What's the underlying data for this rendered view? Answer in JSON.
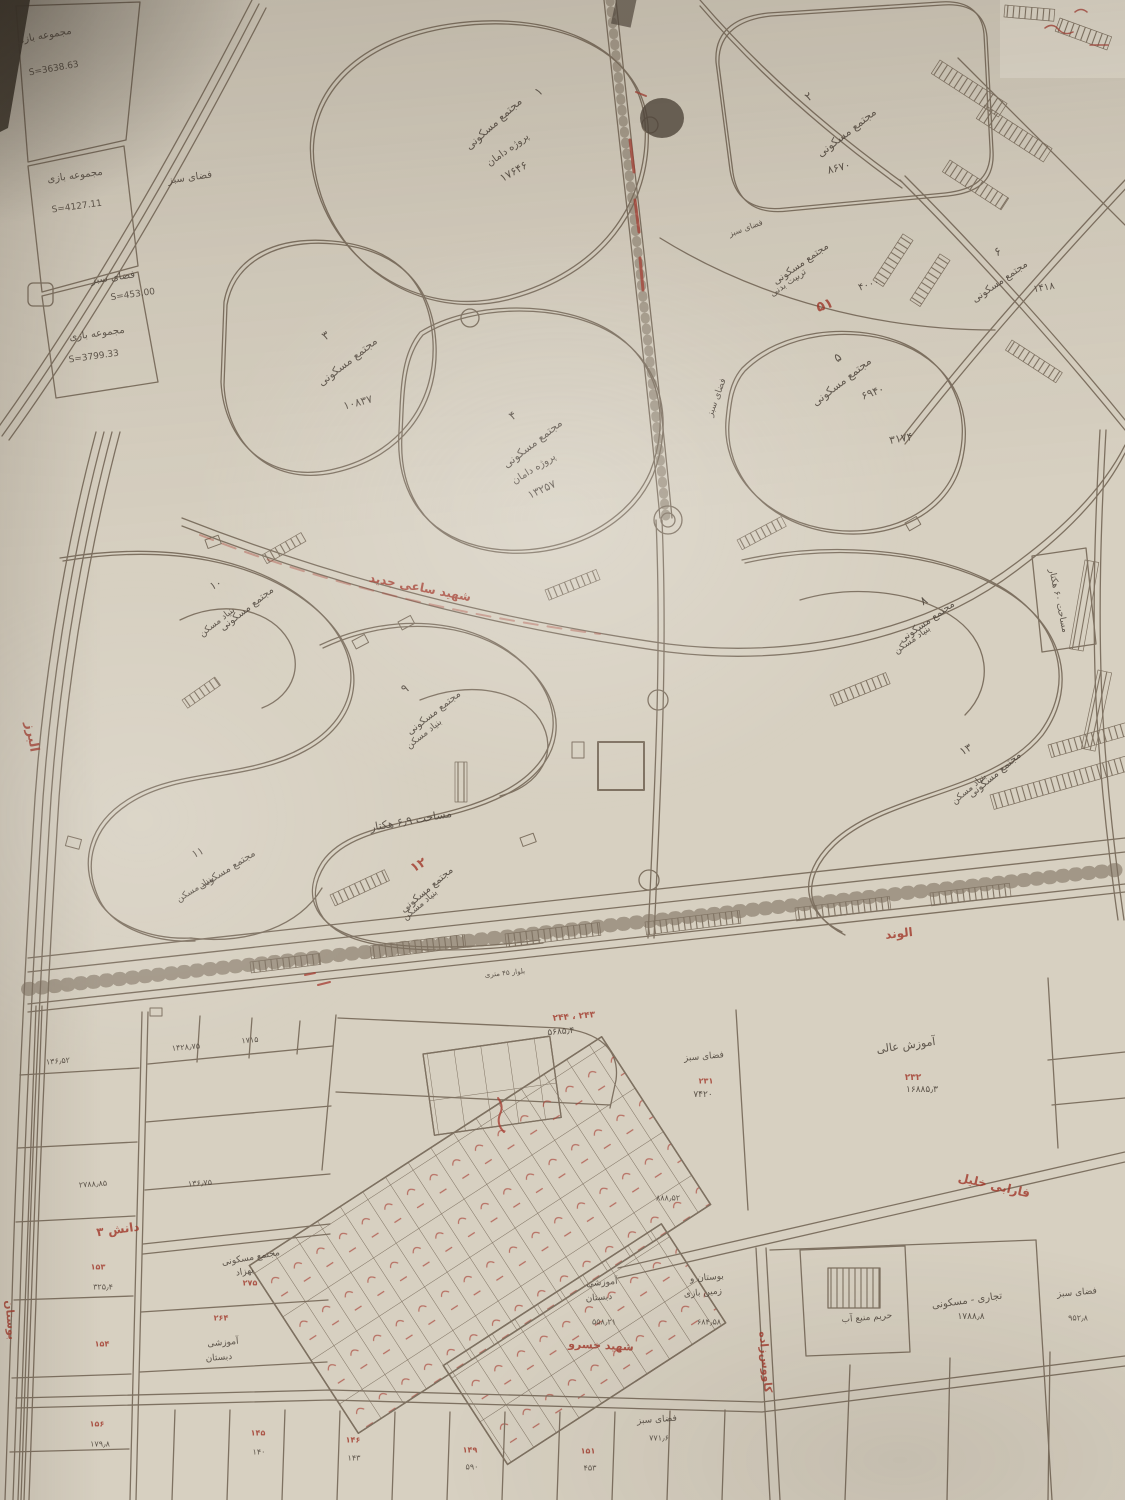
{
  "meta": {
    "paper_color": "#d7d0c1",
    "line_color": "#7e7161",
    "handwriting_color": "#4d443b",
    "annotation_red": "#a23a2d"
  },
  "labels": [
    {
      "n": "parcel-play1-title",
      "t": "مجموعه بازی",
      "x": 44,
      "y": 36,
      "r": -10,
      "s": 10
    },
    {
      "n": "parcel-play1-area",
      "t": "S=3638.63",
      "x": 54,
      "y": 70,
      "r": -10,
      "s": 9
    },
    {
      "n": "parcel-play2-title",
      "t": "مجموعه بازی",
      "x": 75,
      "y": 176,
      "r": -8,
      "s": 10
    },
    {
      "n": "parcel-play2-area",
      "t": "S=4127.11",
      "x": 77,
      "y": 208,
      "r": -8,
      "s": 9
    },
    {
      "n": "green-space-1",
      "t": "فضای سبز",
      "x": 190,
      "y": 178,
      "r": -8,
      "s": 10
    },
    {
      "n": "green-space-2",
      "t": "فضای سبز",
      "x": 113,
      "y": 278,
      "r": -8,
      "s": 10
    },
    {
      "n": "green-space-2-area",
      "t": "S=453.00",
      "x": 133,
      "y": 296,
      "r": -8,
      "s": 9
    },
    {
      "n": "parcel-play3-title",
      "t": "مجموعه بازی",
      "x": 97,
      "y": 334,
      "r": -8,
      "s": 10
    },
    {
      "n": "parcel-play3-area",
      "t": "S=3799.33",
      "x": 94,
      "y": 358,
      "r": -8,
      "s": 9
    },
    {
      "n": "complex1-no",
      "t": "۱",
      "x": 539,
      "y": 92,
      "r": -40,
      "s": 12
    },
    {
      "n": "complex1-title",
      "t": "مجتمع مسکونی",
      "x": 494,
      "y": 124,
      "r": -42,
      "s": 11
    },
    {
      "n": "complex1-sub",
      "t": "پروژه دامان",
      "x": 508,
      "y": 150,
      "r": -36,
      "s": 10
    },
    {
      "n": "complex1-area",
      "t": "۱۷۶۴۶",
      "x": 514,
      "y": 172,
      "r": -30,
      "s": 11
    },
    {
      "n": "complex2-no",
      "t": "۲",
      "x": 809,
      "y": 97,
      "r": -35,
      "s": 12
    },
    {
      "n": "complex2-title",
      "t": "مجتمع مسکونی",
      "x": 847,
      "y": 133,
      "r": -38,
      "s": 11
    },
    {
      "n": "complex2-area",
      "t": "۸۶۷۰",
      "x": 839,
      "y": 168,
      "r": -15,
      "s": 11
    },
    {
      "n": "complex3-no",
      "t": "۳",
      "x": 326,
      "y": 336,
      "r": -35,
      "s": 12
    },
    {
      "n": "complex3-title",
      "t": "مجتمع مسکونی",
      "x": 348,
      "y": 362,
      "r": -38,
      "s": 11
    },
    {
      "n": "complex3-area",
      "t": "۱۰۸۳۷",
      "x": 358,
      "y": 403,
      "r": -15,
      "s": 11
    },
    {
      "n": "complex4-no",
      "t": "۴",
      "x": 513,
      "y": 416,
      "r": -35,
      "s": 12
    },
    {
      "n": "complex4-title",
      "t": "مجتمع مسکونی",
      "x": 533,
      "y": 444,
      "r": -38,
      "s": 11
    },
    {
      "n": "complex4-sub",
      "t": "پروژه دامان",
      "x": 534,
      "y": 469,
      "r": -32,
      "s": 10
    },
    {
      "n": "complex4-area",
      "t": "۱۳۲۵۷",
      "x": 542,
      "y": 490,
      "r": -25,
      "s": 11
    },
    {
      "n": "sport-complex-title",
      "t": "مجتمع مسکونی",
      "x": 801,
      "y": 264,
      "r": -35,
      "s": 10
    },
    {
      "n": "sport-complex-sub",
      "t": "تربیت بدنی",
      "x": 789,
      "y": 284,
      "r": -35,
      "s": 9
    },
    {
      "n": "sport-complex-area",
      "t": "۴۰۰۰",
      "x": 869,
      "y": 285,
      "r": -18,
      "s": 10
    },
    {
      "n": "sport-complex-red-no",
      "t": "۵۱",
      "x": 825,
      "y": 306,
      "r": -20,
      "s": 14,
      "c": "red"
    },
    {
      "n": "complex5-no",
      "t": "۵",
      "x": 838,
      "y": 358,
      "r": -35,
      "s": 12
    },
    {
      "n": "complex5-title",
      "t": "مجتمع مسکونی",
      "x": 842,
      "y": 382,
      "r": -38,
      "s": 11
    },
    {
      "n": "complex5-area",
      "t": "۶۹۴۰",
      "x": 873,
      "y": 393,
      "r": -20,
      "s": 11
    },
    {
      "n": "complex5-area2",
      "t": "۳۱۷۴",
      "x": 901,
      "y": 439,
      "r": -10,
      "s": 11
    },
    {
      "n": "complex6-no",
      "t": "۶",
      "x": 998,
      "y": 252,
      "r": -30,
      "s": 12
    },
    {
      "n": "complex6-title",
      "t": "مجتمع مسکونی",
      "x": 1000,
      "y": 282,
      "r": -35,
      "s": 10
    },
    {
      "n": "complex6-area",
      "t": "۱۴۱۸",
      "x": 1044,
      "y": 288,
      "r": -10,
      "s": 10
    },
    {
      "n": "green-space-3",
      "t": "فضای سبز",
      "x": 746,
      "y": 229,
      "r": -20,
      "s": 8
    },
    {
      "n": "green-space-4",
      "t": "فضای سبز",
      "x": 718,
      "y": 398,
      "r": -70,
      "s": 9
    },
    {
      "n": "complex8-no",
      "t": "۸",
      "x": 924,
      "y": 601,
      "r": -30,
      "s": 12
    },
    {
      "n": "complex8-title",
      "t": "مجتمع مسکونی",
      "x": 927,
      "y": 622,
      "r": -35,
      "s": 10
    },
    {
      "n": "complex8-sub",
      "t": "بنیاد مسکن",
      "x": 913,
      "y": 641,
      "r": -35,
      "s": 9
    },
    {
      "n": "area-60ha-note",
      "t": "مساحت ۶۰ هکتار",
      "x": 1057,
      "y": 601,
      "r": 78,
      "s": 9
    },
    {
      "n": "complex9-no",
      "t": "۹",
      "x": 405,
      "y": 689,
      "r": -30,
      "s": 12
    },
    {
      "n": "complex9-title",
      "t": "مجتمع مسکونی",
      "x": 434,
      "y": 713,
      "r": -38,
      "s": 10
    },
    {
      "n": "complex9-sub",
      "t": "بنیاد مسکن",
      "x": 425,
      "y": 735,
      "r": -38,
      "s": 9
    },
    {
      "n": "complex10-no",
      "t": "۱۰",
      "x": 216,
      "y": 585,
      "r": -25,
      "s": 11
    },
    {
      "n": "complex10-title",
      "t": "مجتمع مسکونی",
      "x": 247,
      "y": 609,
      "r": -38,
      "s": 10
    },
    {
      "n": "complex10-sub",
      "t": "بنیاد مسکن",
      "x": 218,
      "y": 623,
      "r": -38,
      "s": 9
    },
    {
      "n": "complex11-no",
      "t": "۱۱",
      "x": 198,
      "y": 853,
      "r": -25,
      "s": 11
    },
    {
      "n": "complex11-title",
      "t": "مجتمع مسکونی",
      "x": 227,
      "y": 870,
      "r": -32,
      "s": 10
    },
    {
      "n": "complex11-sub",
      "t": "بنیاد مسکن",
      "x": 196,
      "y": 890,
      "r": -32,
      "s": 9
    },
    {
      "n": "area-69ha-note",
      "t": "مساحت ۶٫۹ هکتار",
      "x": 411,
      "y": 821,
      "r": -10,
      "s": 11
    },
    {
      "n": "complex12-no",
      "t": "۱۲",
      "x": 419,
      "y": 866,
      "r": -30,
      "s": 13,
      "c": "red"
    },
    {
      "n": "complex12-title",
      "t": "مجتمع مسکونی",
      "x": 427,
      "y": 890,
      "r": -40,
      "s": 10
    },
    {
      "n": "complex12-sub",
      "t": "بنیاد مسکن",
      "x": 421,
      "y": 906,
      "r": -40,
      "s": 9
    },
    {
      "n": "complex13-no",
      "t": "۱۳",
      "x": 966,
      "y": 750,
      "r": -30,
      "s": 11
    },
    {
      "n": "complex13-title",
      "t": "مجتمع مسکونی",
      "x": 995,
      "y": 775,
      "r": -40,
      "s": 10
    },
    {
      "n": "complex13-sub",
      "t": "بنیاد مسکن",
      "x": 970,
      "y": 790,
      "r": -40,
      "s": 9
    },
    {
      "n": "street-alborz",
      "t": "البرز",
      "x": 31,
      "y": 737,
      "r": 80,
      "s": 13,
      "c": "red"
    },
    {
      "n": "street-main-boulevard",
      "t": "شهید ساعی جدید",
      "x": 420,
      "y": 588,
      "r": 11,
      "s": 12,
      "c": "red",
      "ls": 7
    },
    {
      "n": "street-alvand",
      "t": "الوند",
      "x": 899,
      "y": 934,
      "r": -6,
      "s": 12,
      "c": "red"
    },
    {
      "n": "street-danesh3",
      "t": "دانش ۳",
      "x": 118,
      "y": 1230,
      "r": -8,
      "s": 12,
      "c": "red"
    },
    {
      "n": "street-farabi-khalil",
      "t": "فارابی خلیل",
      "x": 994,
      "y": 1186,
      "r": 13,
      "s": 12,
      "c": "red",
      "ls": 4
    },
    {
      "n": "street-shahid-khosro",
      "t": "شهید خسرو",
      "x": 601,
      "y": 1346,
      "r": 3,
      "s": 11,
      "c": "red"
    },
    {
      "n": "street-kavooszadeh",
      "t": "کاووس‌زاده",
      "x": 765,
      "y": 1362,
      "r": 85,
      "s": 11,
      "c": "red"
    },
    {
      "n": "street-bustan",
      "t": "بوستان",
      "x": 10,
      "y": 1320,
      "r": 85,
      "s": 11,
      "c": "red"
    },
    {
      "n": "road-width-note",
      "t": "بلوار ۴۵ متری",
      "x": 505,
      "y": 974,
      "r": -6,
      "s": 7
    },
    {
      "n": "higher-education-title",
      "t": "آموزش عالی",
      "x": 906,
      "y": 1046,
      "r": -8,
      "s": 11
    },
    {
      "n": "higher-education-red-no",
      "t": "۲۳۲",
      "x": 913,
      "y": 1079,
      "r": 0,
      "s": 9,
      "c": "red"
    },
    {
      "n": "higher-education-area",
      "t": "۱۶۸۸۵٫۳",
      "x": 922,
      "y": 1091,
      "r": 0,
      "s": 9
    },
    {
      "n": "green-space-5",
      "t": "فضای سبز",
      "x": 704,
      "y": 1058,
      "r": -5,
      "s": 9
    },
    {
      "n": "green-space-5-red-no",
      "t": "۲۳۱",
      "x": 706,
      "y": 1082,
      "r": 0,
      "s": 8,
      "c": "red"
    },
    {
      "n": "green-space-5-area",
      "t": "۷۴۲۰",
      "x": 703,
      "y": 1096,
      "r": 0,
      "s": 9
    },
    {
      "n": "big-lot-red-no",
      "t": "۲۴۳ ، ۲۴۴",
      "x": 574,
      "y": 1018,
      "r": -5,
      "s": 9,
      "c": "red"
    },
    {
      "n": "big-lot-area",
      "t": "۵۶۸۵٫۴",
      "x": 561,
      "y": 1033,
      "r": -5,
      "s": 9
    },
    {
      "n": "lot-area-1",
      "t": "۱۴۲۸٫۷۵",
      "x": 186,
      "y": 1048,
      "r": -5,
      "s": 8
    },
    {
      "n": "lot-area-2",
      "t": "۱۷۱۵",
      "x": 250,
      "y": 1041,
      "r": -5,
      "s": 8
    },
    {
      "n": "lot-area-3",
      "t": "۱۳۶٫۵۲",
      "x": 58,
      "y": 1062,
      "r": -5,
      "s": 8
    },
    {
      "n": "lot-area-4",
      "t": "۲۷۸۸٫۸۵",
      "x": 93,
      "y": 1185,
      "r": -4,
      "s": 8
    },
    {
      "n": "lot-area-5",
      "t": "۱۳۶٫۷۵",
      "x": 200,
      "y": 1184,
      "r": -4,
      "s": 8
    },
    {
      "n": "lot-153-no",
      "t": "۱۵۳",
      "x": 98,
      "y": 1268,
      "r": 0,
      "s": 8,
      "c": "red"
    },
    {
      "n": "lot-153-area",
      "t": "۳۲۵٫۴",
      "x": 103,
      "y": 1288,
      "r": 0,
      "s": 8
    },
    {
      "n": "lot-154-no",
      "t": "۱۵۴",
      "x": 102,
      "y": 1345,
      "r": 0,
      "s": 8,
      "c": "red"
    },
    {
      "n": "behzad-complex-title",
      "t": "مجتمع مسکونی",
      "x": 251,
      "y": 1259,
      "r": -10,
      "s": 9
    },
    {
      "n": "behzad-complex-sub",
      "t": "بهزاد",
      "x": 245,
      "y": 1273,
      "r": -10,
      "s": 9
    },
    {
      "n": "behzad-complex-red-no",
      "t": "۲۷۵",
      "x": 250,
      "y": 1284,
      "r": 0,
      "s": 8,
      "c": "red"
    },
    {
      "n": "school1-line1",
      "t": "آموزشی",
      "x": 223,
      "y": 1344,
      "r": -5,
      "s": 9
    },
    {
      "n": "school1-line2",
      "t": "دبستان",
      "x": 219,
      "y": 1359,
      "r": -5,
      "s": 9
    },
    {
      "n": "school1-red-no",
      "t": "۲۶۴",
      "x": 221,
      "y": 1319,
      "r": 0,
      "s": 8,
      "c": "red"
    },
    {
      "n": "school2-line1",
      "t": "آموزشی",
      "x": 602,
      "y": 1284,
      "r": -5,
      "s": 9
    },
    {
      "n": "school2-line2",
      "t": "دبستان",
      "x": 599,
      "y": 1299,
      "r": -5,
      "s": 9
    },
    {
      "n": "school2-area",
      "t": "۵۵۸٫۲۱",
      "x": 604,
      "y": 1323,
      "r": 0,
      "s": 8
    },
    {
      "n": "park-line1",
      "t": "بوستان و",
      "x": 707,
      "y": 1279,
      "r": -5,
      "s": 9
    },
    {
      "n": "park-line2",
      "t": "زمین بازی",
      "x": 703,
      "y": 1294,
      "r": -5,
      "s": 9
    },
    {
      "n": "park-area",
      "t": "۶۸۴٫۵۸",
      "x": 709,
      "y": 1323,
      "r": 0,
      "s": 8
    },
    {
      "n": "lot-area-6",
      "t": "۸۸۸٫۵۲",
      "x": 668,
      "y": 1199,
      "r": 0,
      "s": 8
    },
    {
      "n": "commercial-title",
      "t": "تجاری - مسکونی",
      "x": 967,
      "y": 1301,
      "r": -8,
      "s": 10
    },
    {
      "n": "commercial-area",
      "t": "۱۷۸۸٫۸",
      "x": 971,
      "y": 1318,
      "r": 0,
      "s": 9
    },
    {
      "n": "water-buffer-title",
      "t": "حریم منبع آب",
      "x": 867,
      "y": 1319,
      "r": -5,
      "s": 9
    },
    {
      "n": "green-space-6",
      "t": "فضای سبز",
      "x": 1077,
      "y": 1294,
      "r": -5,
      "s": 9
    },
    {
      "n": "green-space-6-area",
      "t": "۹۵۲٫۸",
      "x": 1078,
      "y": 1319,
      "r": 0,
      "s": 8
    },
    {
      "n": "green-space-7",
      "t": "فضای سبز",
      "x": 657,
      "y": 1421,
      "r": -4,
      "s": 9
    },
    {
      "n": "green-space-7-area",
      "t": "۷۷۱٫۶",
      "x": 659,
      "y": 1439,
      "r": 0,
      "s": 8
    },
    {
      "n": "lot-156-no",
      "t": "۱۵۶",
      "x": 97,
      "y": 1425,
      "r": 0,
      "s": 8,
      "c": "red"
    },
    {
      "n": "lot-156-area",
      "t": "۱۷۹٫۸",
      "x": 100,
      "y": 1445,
      "r": 0,
      "s": 8
    },
    {
      "n": "lot-145-no",
      "t": "۱۴۵",
      "x": 258,
      "y": 1434,
      "r": 0,
      "s": 8,
      "c": "red"
    },
    {
      "n": "lot-145-area",
      "t": "۱۴۰",
      "x": 259,
      "y": 1453,
      "r": 0,
      "s": 8
    },
    {
      "n": "lot-146-no",
      "t": "۱۴۶",
      "x": 353,
      "y": 1441,
      "r": 0,
      "s": 8,
      "c": "red"
    },
    {
      "n": "lot-146-area",
      "t": "۱۴۳",
      "x": 354,
      "y": 1459,
      "r": 0,
      "s": 8
    },
    {
      "n": "lot-149-no",
      "t": "۱۴۹",
      "x": 470,
      "y": 1451,
      "r": 0,
      "s": 8,
      "c": "red"
    },
    {
      "n": "lot-149-area",
      "t": "۵۹۰",
      "x": 472,
      "y": 1468,
      "r": 0,
      "s": 8
    },
    {
      "n": "lot-151-no",
      "t": "۱۵۱",
      "x": 588,
      "y": 1452,
      "r": 0,
      "s": 8,
      "c": "red"
    },
    {
      "n": "lot-151-area",
      "t": "۴۵۳",
      "x": 590,
      "y": 1469,
      "r": 0,
      "s": 8
    }
  ]
}
